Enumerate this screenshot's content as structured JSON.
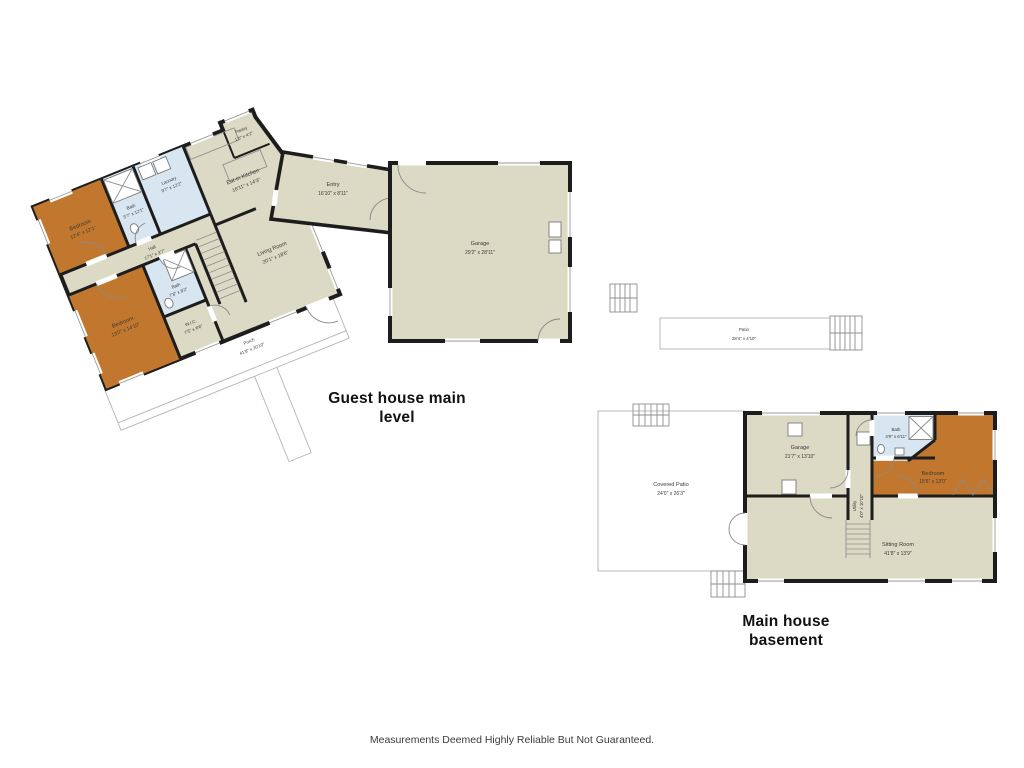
{
  "colors": {
    "room_fill": "#dcd9c4",
    "bedroom_fill": "#c1782e",
    "bath_fill": "#d7e6f0",
    "wall": "#1d1d1d"
  },
  "footer": {
    "disclaimer": "Measurements Deemed Highly Reliable But Not Guaranteed."
  },
  "plans": {
    "guest_house": {
      "title_line1": "Guest house main",
      "title_line2": "level",
      "rooms": {
        "bedroom1": {
          "name": "Bedroom",
          "dims": "12'4\" x 12'1\""
        },
        "bath1": {
          "name": "Bath",
          "dims": "5'7\" x 12'1\""
        },
        "laundry": {
          "name": "Laundry",
          "dims": "9'7\" x 12'2\""
        },
        "pantry": {
          "name": "Pantry",
          "dims": "1'0\" x 4'2\""
        },
        "kitchen": {
          "name": "Eat-in Kitchen",
          "dims": "16'11\" x 14'3\""
        },
        "entry": {
          "name": "Entry",
          "dims": "16'10\" x 8'11\""
        },
        "hall": {
          "name": "Hall",
          "dims": "17'1\" x 3'7\""
        },
        "living": {
          "name": "Living Room",
          "dims": "20'1\" x 18'6\""
        },
        "bedroom2": {
          "name": "Bedroom",
          "dims": "13'0\" x 14'10\""
        },
        "bath2": {
          "name": "Bath",
          "dims": "7'8\" x 8'2\""
        },
        "wic": {
          "name": "W.I.C.",
          "dims": "7'5\" x 6'6\""
        },
        "porch": {
          "name": "Porch",
          "dims": "41'8\" x 20'10\""
        },
        "garage": {
          "name": "Garage",
          "dims": "29'2\" x 28'11\""
        },
        "patio": {
          "name": "Patio",
          "dims": "28'4\" x 4'10\""
        }
      }
    },
    "main_house": {
      "title_line1": "Main house",
      "title_line2": "basement",
      "rooms": {
        "covered_patio": {
          "name": "Covered Patio",
          "dims": "24'0\" x 26'3\""
        },
        "garage": {
          "name": "Garage",
          "dims": "21'7\" x 13'10\""
        },
        "bath": {
          "name": "Bath",
          "dims": "4'9\" x 6'11\""
        },
        "bedroom": {
          "name": "Bedroom",
          "dims": "15'6\" x 13'0\""
        },
        "utility": {
          "name": "Utility",
          "dims": "4'0\" x 10'10\""
        },
        "sitting": {
          "name": "Sitting Room",
          "dims": "41'8\" x 13'9\""
        }
      }
    }
  }
}
